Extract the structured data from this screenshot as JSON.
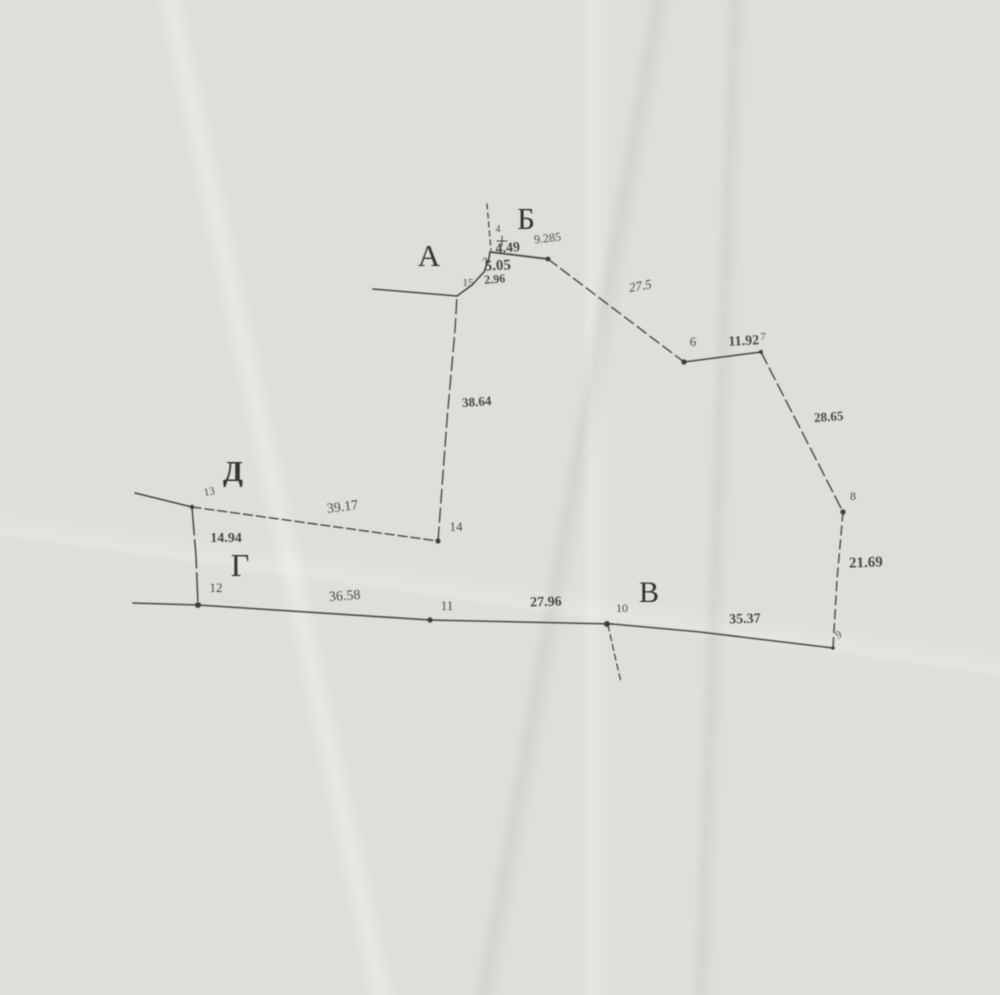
{
  "meta": {
    "description": "Scanned hand-drafted land-survey boundary sketch (photocopy on grey paper)",
    "ink_color": "#3b3831",
    "letter_color": "#2e2b24",
    "paper_color": "#dfdeda"
  },
  "survey": {
    "corner_letters": [
      "А",
      "Б",
      "В",
      "Г",
      "Д"
    ],
    "point_numbers": [
      "3",
      "4",
      "6",
      "7",
      "8",
      "9",
      "10",
      "11",
      "12",
      "13",
      "14",
      "15"
    ],
    "segment_lengths": [
      "4.49",
      "9.285",
      "5.05",
      "2.96",
      "27.5",
      "11.92",
      "28.65",
      "21.69",
      "35.37",
      "27.96",
      "36.58",
      "14.94",
      "39.17",
      "38.64"
    ]
  },
  "diagram": {
    "ink": "#3b3831",
    "polylines": [
      {
        "name": "boundary-left-stub-A",
        "pts": [
          [
            373,
            289
          ],
          [
            457,
            296
          ]
        ],
        "w": 1.5
      },
      {
        "name": "boundary-corner-curve",
        "pts": [
          [
            457,
            296
          ],
          [
            472,
            285
          ],
          [
            484,
            272
          ],
          [
            489,
            258
          ],
          [
            490,
            252
          ]
        ],
        "w": 1.6
      },
      {
        "name": "boundary-seg-4-49",
        "pts": [
          [
            490,
            252
          ],
          [
            548,
            259
          ]
        ],
        "w": 1.7
      },
      {
        "name": "boundary-seg-27-5",
        "pts": [
          [
            548,
            259
          ],
          [
            684,
            362
          ]
        ],
        "w": 1.4,
        "dash": "11 5"
      },
      {
        "name": "boundary-seg-11-92",
        "pts": [
          [
            684,
            362
          ],
          [
            761,
            352
          ]
        ],
        "w": 1.5
      },
      {
        "name": "boundary-seg-28-65",
        "pts": [
          [
            761,
            352
          ],
          [
            820,
            467
          ],
          [
            843,
            512
          ]
        ],
        "w": 1.4,
        "dash": "13 5"
      },
      {
        "name": "boundary-seg-21-69",
        "pts": [
          [
            843,
            512
          ],
          [
            837,
            580
          ],
          [
            833,
            648
          ]
        ],
        "w": 1.4,
        "dash": "9 5"
      },
      {
        "name": "boundary-seg-35-37",
        "pts": [
          [
            833,
            648
          ],
          [
            700,
            632
          ],
          [
            612,
            624
          ]
        ],
        "w": 1.5
      },
      {
        "name": "boundary-seg-27-96",
        "pts": [
          [
            612,
            624
          ],
          [
            430,
            620
          ]
        ],
        "w": 1.6
      },
      {
        "name": "boundary-seg-36-58",
        "pts": [
          [
            430,
            620
          ],
          [
            198,
            605
          ]
        ],
        "w": 1.6
      },
      {
        "name": "boundary-seg-12-left",
        "pts": [
          [
            198,
            605
          ],
          [
            133,
            603
          ]
        ],
        "w": 1.6
      },
      {
        "name": "boundary-left-13",
        "pts": [
          [
            135,
            493
          ],
          [
            192,
            507
          ]
        ],
        "w": 1.5
      },
      {
        "name": "boundary-seg-39-17",
        "pts": [
          [
            192,
            507
          ],
          [
            438,
            541
          ]
        ],
        "w": 1.4,
        "dash": "9 4"
      },
      {
        "name": "boundary-seg-38-64",
        "pts": [
          [
            438,
            541
          ],
          [
            447,
            420
          ],
          [
            455,
            330
          ],
          [
            457,
            296
          ]
        ],
        "w": 1.4,
        "dash": "14 5"
      },
      {
        "name": "boundary-seg-14-94",
        "pts": [
          [
            192,
            507
          ],
          [
            196,
            556
          ],
          [
            198,
            605
          ]
        ],
        "w": 1.5,
        "dash": "28 5"
      },
      {
        "name": "dashed-line-top",
        "pts": [
          [
            487,
            204
          ],
          [
            489,
            228
          ],
          [
            491,
            250
          ]
        ],
        "w": 1.3,
        "dash": "5 4"
      },
      {
        "name": "dashed-line-below-10",
        "pts": [
          [
            608,
            625
          ],
          [
            614,
            652
          ],
          [
            621,
            682
          ]
        ],
        "w": 1.3,
        "dash": "6 4"
      },
      {
        "name": "plus-mark-h",
        "pts": [
          [
            497,
            241
          ],
          [
            507,
            241
          ]
        ],
        "w": 1
      },
      {
        "name": "plus-mark-v",
        "pts": [
          [
            502,
            236
          ],
          [
            502,
            246
          ]
        ],
        "w": 1
      }
    ],
    "dots": [
      {
        "name": "point-dot-5",
        "x": 548,
        "y": 259,
        "r": 2.4
      },
      {
        "name": "point-dot-6",
        "x": 684,
        "y": 362,
        "r": 2.7
      },
      {
        "name": "point-dot-7",
        "x": 761,
        "y": 352,
        "r": 2.0
      },
      {
        "name": "point-dot-8",
        "x": 843,
        "y": 512,
        "r": 2.7
      },
      {
        "name": "point-dot-9",
        "x": 833,
        "y": 648,
        "r": 1.8
      },
      {
        "name": "point-dot-10",
        "x": 607,
        "y": 624,
        "r": 3.0
      },
      {
        "name": "point-dot-11",
        "x": 430,
        "y": 620,
        "r": 2.7
      },
      {
        "name": "point-dot-12",
        "x": 198,
        "y": 605,
        "r": 3.0
      },
      {
        "name": "point-dot-13",
        "x": 192,
        "y": 507,
        "r": 2.2
      },
      {
        "name": "point-dot-14",
        "x": 438,
        "y": 541,
        "r": 2.6
      }
    ],
    "labels": [
      {
        "name": "corner-letter-A",
        "t": "А",
        "x": 429,
        "y": 266,
        "s": 31,
        "b": false,
        "i": false,
        "r": 0,
        "letter": true
      },
      {
        "name": "corner-letter-B",
        "t": "Б",
        "x": 526,
        "y": 229,
        "s": 31,
        "b": false,
        "i": false,
        "r": 0,
        "letter": true
      },
      {
        "name": "corner-letter-V",
        "t": "В",
        "x": 649,
        "y": 602,
        "s": 30,
        "b": false,
        "i": false,
        "r": 0,
        "letter": true
      },
      {
        "name": "corner-letter-G",
        "t": "Г",
        "x": 240,
        "y": 576,
        "s": 32,
        "b": false,
        "i": false,
        "r": 0,
        "letter": true
      },
      {
        "name": "corner-letter-D",
        "t": "Д",
        "x": 233,
        "y": 481,
        "s": 29,
        "b": true,
        "i": false,
        "r": 0,
        "letter": true
      },
      {
        "name": "point-label-4",
        "t": "4",
        "x": 498,
        "y": 232,
        "s": 10,
        "b": false,
        "i": false,
        "r": 0
      },
      {
        "name": "length-4-49",
        "t": "4.49",
        "x": 508,
        "y": 252,
        "s": 14,
        "b": true,
        "i": false,
        "r": -4
      },
      {
        "name": "length-9-285",
        "t": "9.285",
        "x": 548,
        "y": 242,
        "s": 12,
        "b": false,
        "i": false,
        "r": -7
      },
      {
        "name": "length-5-05",
        "t": "5.05",
        "x": 498,
        "y": 270,
        "s": 15,
        "b": true,
        "i": false,
        "r": -3
      },
      {
        "name": "point-label-3",
        "t": "3",
        "x": 489,
        "y": 263,
        "s": 11,
        "b": false,
        "i": false,
        "r": -50
      },
      {
        "name": "point-label-15",
        "t": "15",
        "x": 468,
        "y": 286,
        "s": 11,
        "b": false,
        "i": false,
        "r": 0
      },
      {
        "name": "length-2-96",
        "t": "2.96",
        "x": 495,
        "y": 283,
        "s": 12,
        "b": true,
        "i": false,
        "r": -4
      },
      {
        "name": "length-27-5",
        "t": "27.5",
        "x": 641,
        "y": 290,
        "s": 13,
        "b": false,
        "i": true,
        "r": -10
      },
      {
        "name": "point-label-6",
        "t": "6",
        "x": 693,
        "y": 346,
        "s": 13,
        "b": false,
        "i": false,
        "r": 0
      },
      {
        "name": "length-11-92",
        "t": "11.92",
        "x": 744,
        "y": 345,
        "s": 14,
        "b": true,
        "i": false,
        "r": -3
      },
      {
        "name": "point-label-7",
        "t": "7",
        "x": 763,
        "y": 340,
        "s": 11,
        "b": false,
        "i": false,
        "r": 0
      },
      {
        "name": "length-28-65",
        "t": "28.65",
        "x": 829,
        "y": 421,
        "s": 13,
        "b": true,
        "i": false,
        "r": -4
      },
      {
        "name": "point-label-8",
        "t": "8",
        "x": 853,
        "y": 500,
        "s": 12,
        "b": false,
        "i": false,
        "r": 0
      },
      {
        "name": "length-21-69",
        "t": "21.69",
        "x": 866,
        "y": 567,
        "s": 15,
        "b": true,
        "i": false,
        "r": -2
      },
      {
        "name": "point-label-9",
        "t": "9",
        "x": 840,
        "y": 638,
        "s": 11,
        "b": false,
        "i": false,
        "r": -25
      },
      {
        "name": "length-35-37",
        "t": "35.37",
        "x": 745,
        "y": 623,
        "s": 14,
        "b": true,
        "i": false,
        "r": -2
      },
      {
        "name": "point-label-10",
        "t": "10",
        "x": 622,
        "y": 612,
        "s": 12,
        "b": false,
        "i": false,
        "r": 0
      },
      {
        "name": "length-27-96",
        "t": "27.96",
        "x": 546,
        "y": 606,
        "s": 14,
        "b": true,
        "i": false,
        "r": -2
      },
      {
        "name": "point-label-11",
        "t": "11",
        "x": 447,
        "y": 610,
        "s": 13,
        "b": false,
        "i": false,
        "r": 0
      },
      {
        "name": "length-36-58",
        "t": "36.58",
        "x": 345,
        "y": 600,
        "s": 14,
        "b": false,
        "i": false,
        "r": -4
      },
      {
        "name": "point-label-12",
        "t": "12",
        "x": 216,
        "y": 592,
        "s": 13,
        "b": false,
        "i": false,
        "r": 0
      },
      {
        "name": "length-14-94",
        "t": "14.94",
        "x": 226,
        "y": 542,
        "s": 14,
        "b": true,
        "i": false,
        "r": 0
      },
      {
        "name": "point-label-13",
        "t": "13",
        "x": 210,
        "y": 495,
        "s": 11,
        "b": false,
        "i": false,
        "r": -12
      },
      {
        "name": "length-39-17",
        "t": "39.17",
        "x": 343,
        "y": 511,
        "s": 14,
        "b": false,
        "i": false,
        "r": -7
      },
      {
        "name": "point-label-14",
        "t": "14",
        "x": 456,
        "y": 531,
        "s": 13,
        "b": false,
        "i": false,
        "r": 0
      },
      {
        "name": "length-38-64",
        "t": "38.64",
        "x": 477,
        "y": 406,
        "s": 13,
        "b": true,
        "i": false,
        "r": -4
      }
    ]
  }
}
